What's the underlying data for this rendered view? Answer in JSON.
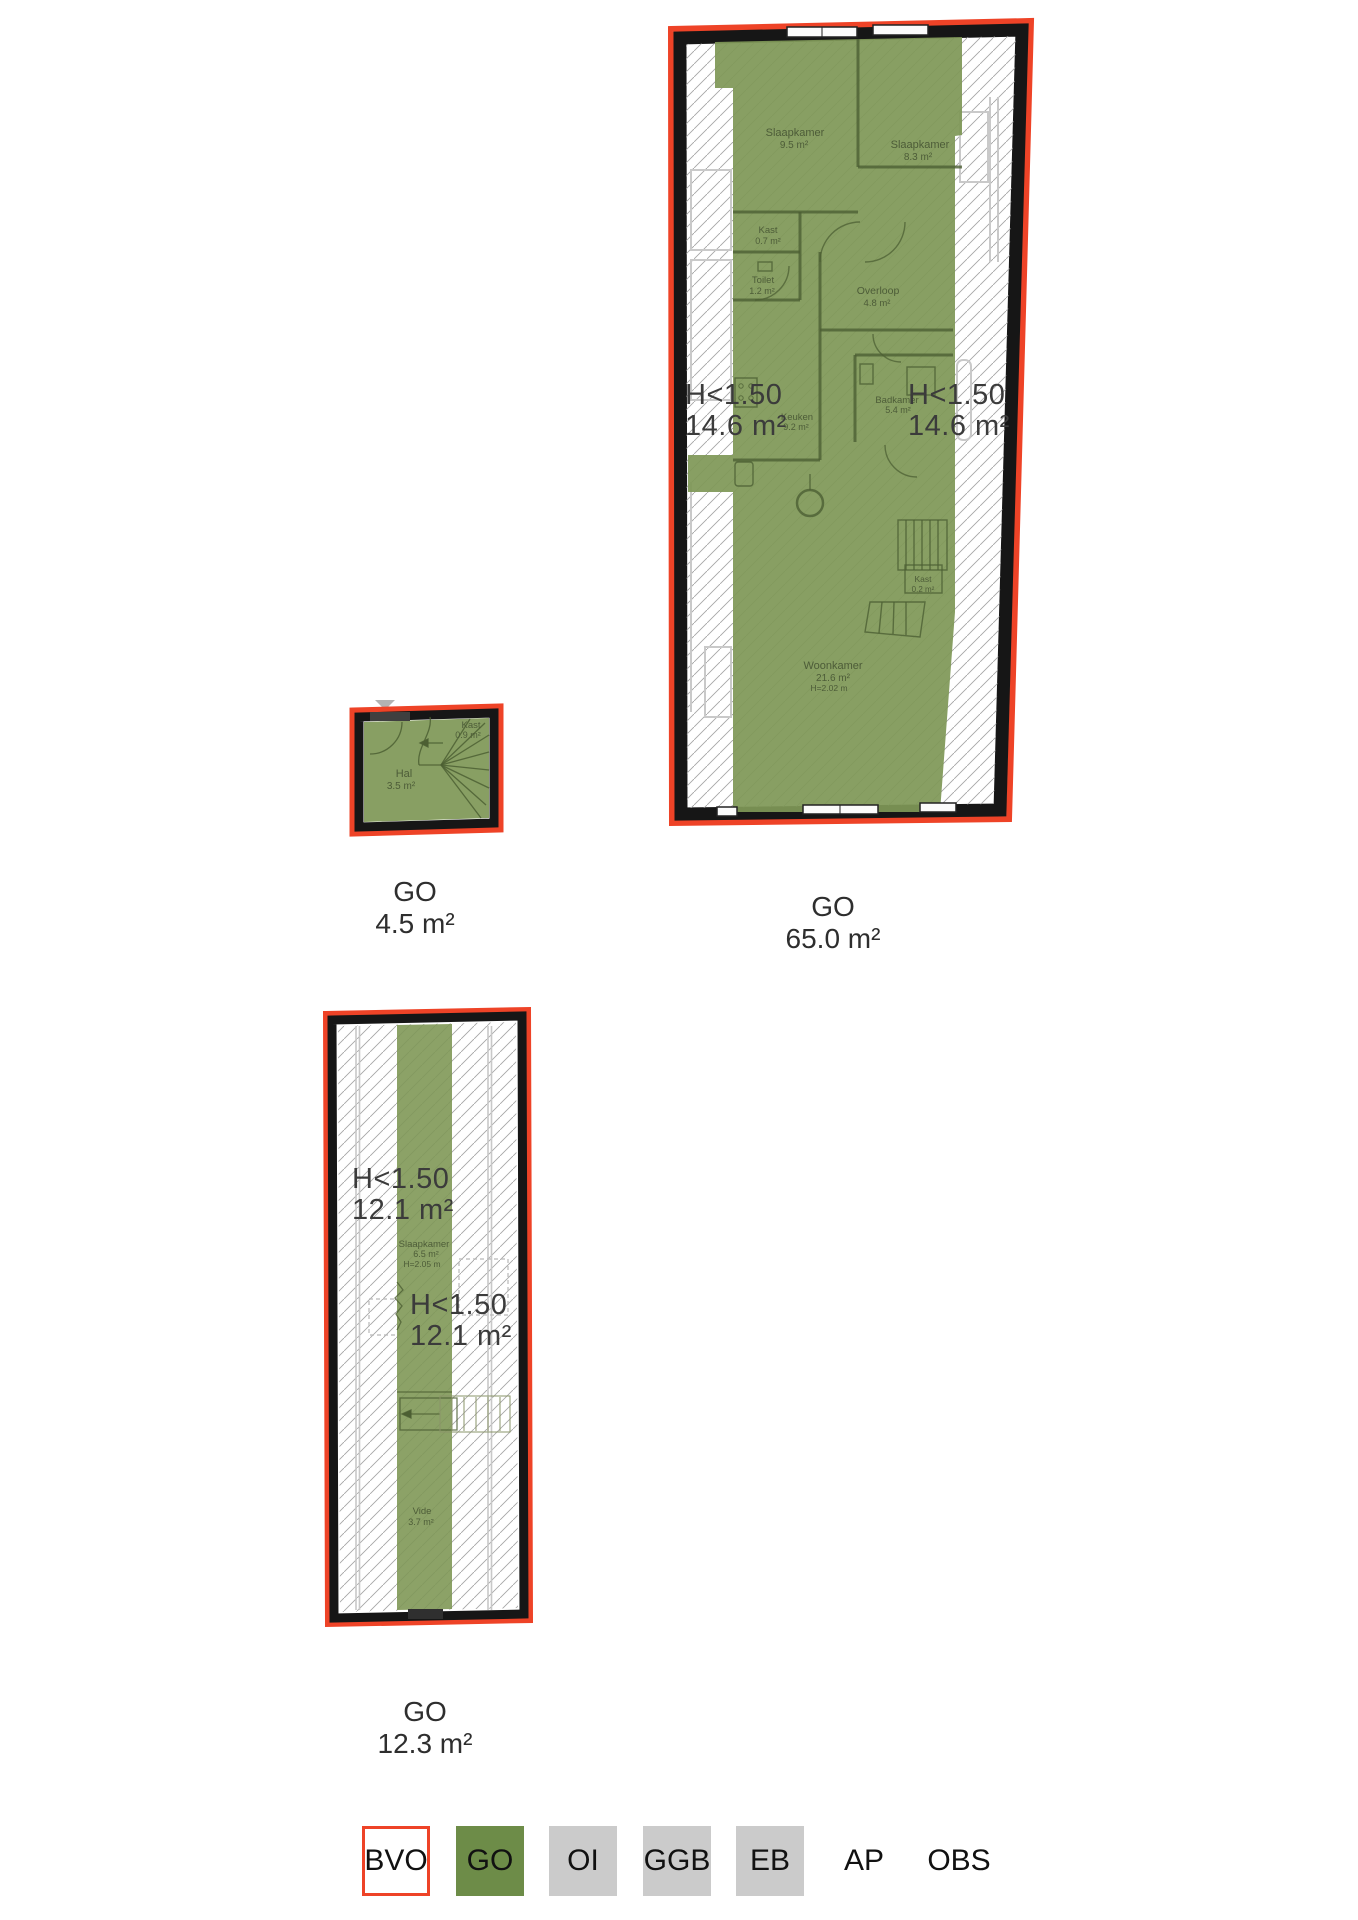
{
  "colors": {
    "bvo_red": "#ee4327",
    "go_green_legend": "#6d8c48",
    "go_green_plan": "#7f9857",
    "legend_gray": "#cbcbcb",
    "wall_black": "#161616",
    "hatch_gray": "#a6a6a6",
    "underlay_gray": "#c9c9c9",
    "room_label_green": "#4d5c38",
    "height_label_gray": "#3b3b3b"
  },
  "plans": {
    "floor1": {
      "caption": {
        "label": "GO",
        "value": "65.0 m²"
      },
      "height_labels": {
        "left": {
          "l1": "H<1.50",
          "l2": "14.6 m²"
        },
        "right": {
          "l1": "H<1.50",
          "l2": "14.6 m²"
        }
      },
      "rooms": {
        "slaapkamer1": {
          "name": "Slaapkamer",
          "area": "9.5 m²"
        },
        "slaapkamer2": {
          "name": "Slaapkamer",
          "area": "8.3 m²"
        },
        "kast1": {
          "name": "Kast",
          "area": "0.7 m²"
        },
        "toilet": {
          "name": "Toilet",
          "area": "1.2 m²"
        },
        "overloop": {
          "name": "Overloop",
          "area": "4.8 m²"
        },
        "badkamer": {
          "name": "Badkamer",
          "area": "5.4 m²"
        },
        "keuken": {
          "name": "Keuken",
          "area": "9.2 m²"
        },
        "woonkamer": {
          "name": "Woonkamer",
          "area": "21.6 m²",
          "height": "H=2.02 m"
        },
        "kast2": {
          "name": "Kast",
          "area": "0.2 m²"
        }
      }
    },
    "hal": {
      "caption": {
        "label": "GO",
        "value": "4.5 m²"
      },
      "rooms": {
        "kast": {
          "name": "Kast",
          "area": "0.9 m²"
        },
        "hal": {
          "name": "Hal",
          "area": "3.5 m²"
        }
      }
    },
    "attic": {
      "caption": {
        "label": "GO",
        "value": "12.3 m²"
      },
      "height_labels": {
        "upper": {
          "l1": "H<1.50",
          "l2": "12.1 m²"
        },
        "lower": {
          "l1": "H<1.50",
          "l2": "12.1 m²"
        }
      },
      "rooms": {
        "slaapkamer": {
          "name": "Slaapkamer",
          "area": "6.5 m²",
          "height": "H=2.05 m"
        },
        "vide": {
          "name": "Vide",
          "area": "3.7 m²"
        }
      }
    }
  },
  "legend": {
    "items": [
      {
        "label": "BVO",
        "style": "bvo"
      },
      {
        "label": "GO",
        "style": "go"
      },
      {
        "label": "OI",
        "style": "gray"
      },
      {
        "label": "GGB",
        "style": "gray"
      },
      {
        "label": "EB",
        "style": "gray"
      },
      {
        "label": "AP",
        "style": "plain"
      },
      {
        "label": "OBS",
        "style": "plain"
      }
    ]
  }
}
